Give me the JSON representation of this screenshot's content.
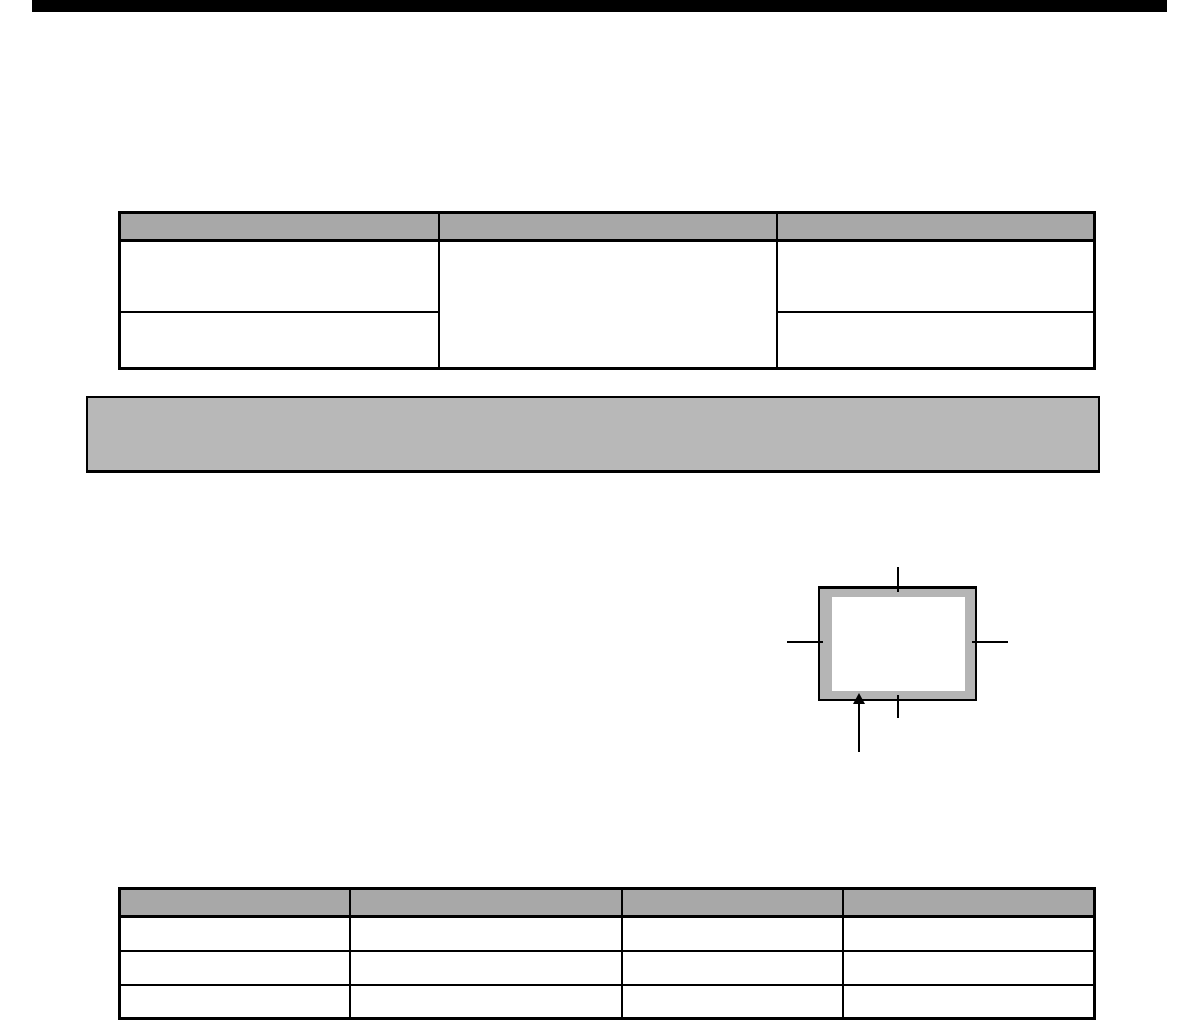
{
  "page": {
    "background_color": "#ffffff"
  },
  "header_rule": {
    "color": "#000000"
  },
  "table_top": {
    "column_count": 3,
    "header_fill": "#a8a8a8",
    "border_color": "#000000",
    "headers": [
      "",
      "",
      ""
    ],
    "col1_rows": [
      "",
      ""
    ],
    "col2_merged": "",
    "col3_rows": [
      "",
      ""
    ]
  },
  "shaded_callout": {
    "fill": "#b8b8b8",
    "border_color": "#000000",
    "text": ""
  },
  "margin_figure": {
    "frame_fill": "#b5b5b5",
    "frame_border_color": "#000000",
    "inner_fill": "#ffffff",
    "marks": [
      "top-crop-mark",
      "left-crop-mark",
      "right-crop-mark",
      "bottom-crop-mark"
    ],
    "arrow": "up-arrow"
  },
  "table_bottom": {
    "column_count": 4,
    "header_fill": "#a8a8a8",
    "border_color": "#000000",
    "headers": [
      "",
      "",
      "",
      ""
    ],
    "rows": [
      [
        "",
        "",
        "",
        ""
      ],
      [
        "",
        "",
        "",
        ""
      ],
      [
        "",
        "",
        "",
        ""
      ]
    ]
  }
}
